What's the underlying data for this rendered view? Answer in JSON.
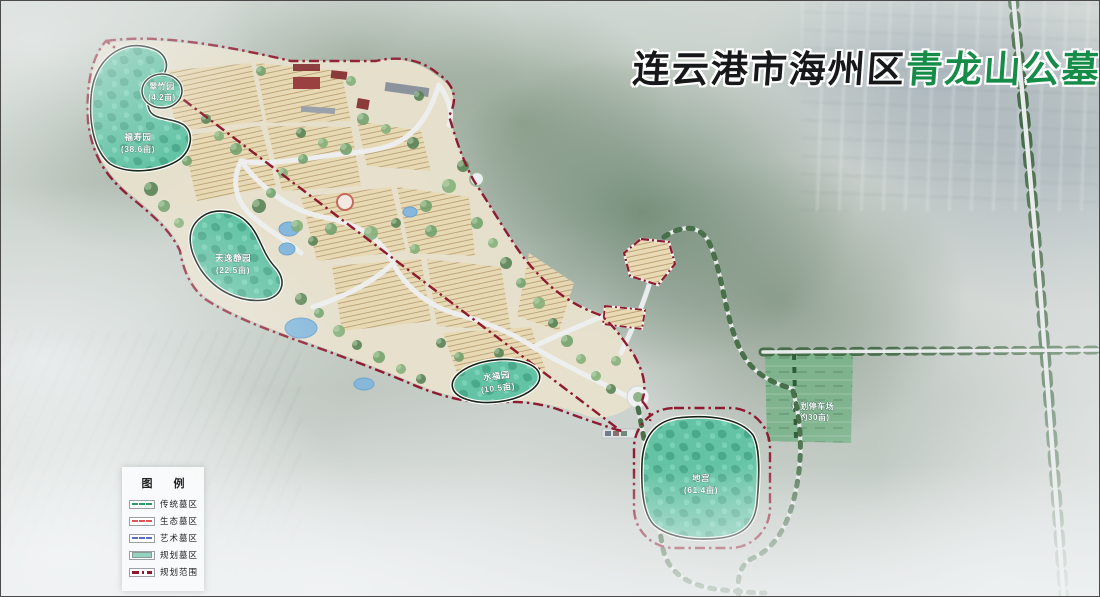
{
  "title": {
    "black_part": "连云港市海州区",
    "green_part": "青龙山公墓",
    "green_color": "#158c47"
  },
  "legend": {
    "title": "图  例",
    "items": [
      {
        "label": "传统墓区",
        "style": "dashed-line",
        "color": "#2f9a68"
      },
      {
        "label": "生态墓区",
        "style": "dashed-line",
        "color": "#e05555"
      },
      {
        "label": "艺术墓区",
        "style": "dashed-line",
        "color": "#5a6cc5"
      },
      {
        "label": "规划墓区",
        "style": "filled-swatch",
        "color": "#92d2bf"
      },
      {
        "label": "规划范围",
        "style": "dashdot-line",
        "color": "#8e1a2e"
      }
    ]
  },
  "areas": {
    "cuizhuyuan": {
      "name": "翠竹园",
      "size": "(4.2亩)"
    },
    "fushouyuan": {
      "name": "福寿园",
      "size": "(38.6亩)"
    },
    "tianyijingyuan": {
      "name": "天逸静园",
      "size": "(22.5亩)"
    },
    "shuifuyuan": {
      "name": "水福园",
      "size": "(10.5亩)"
    },
    "digong": {
      "name": "地宫",
      "size": "(61.4亩)"
    },
    "parking": {
      "name": "规划停车场",
      "size": "(约30亩)"
    }
  },
  "colors": {
    "planned_area_fill": "#63c3a4",
    "boundary": "#8e1b2f",
    "plot_fill": "#e9d9b4",
    "road": "#eef0f1"
  }
}
